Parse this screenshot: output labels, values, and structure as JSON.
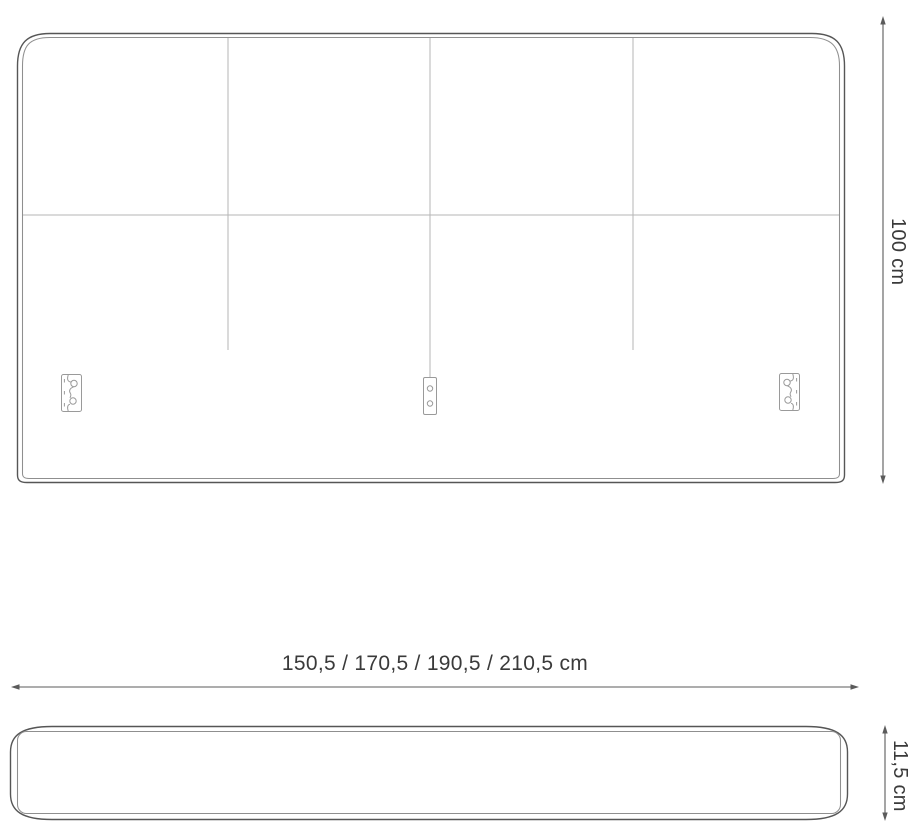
{
  "page": {
    "type": "furniture-dimension-diagram",
    "subject": "upholstered headboard technical drawing",
    "background": "#ffffff"
  },
  "colors": {
    "outline": "#565656",
    "inner_seam": "#8f8f8f",
    "panel_seam": "#b5b5b5",
    "bracket": "#9a9a9a",
    "dimension_line": "#5b5b5b",
    "label_text": "#3a3a3a"
  },
  "views": {
    "front": {
      "name": "headboard front view",
      "panel_columns": 4,
      "panel_rows": 2,
      "mount_bracket_count": 3
    },
    "profile": {
      "name": "headboard top profile view"
    }
  },
  "dimensions": {
    "height": {
      "label": "100 cm"
    },
    "width": {
      "label": "150,5 / 170,5 / 190,5 / 210,5 cm"
    },
    "depth": {
      "label": "11,5 cm"
    }
  },
  "icons": {
    "left_bracket": "keyhole-wall-mount-bracket-icon",
    "center_bracket": "screw-plate-bracket-icon",
    "right_bracket": "keyhole-wall-mount-bracket-icon"
  }
}
